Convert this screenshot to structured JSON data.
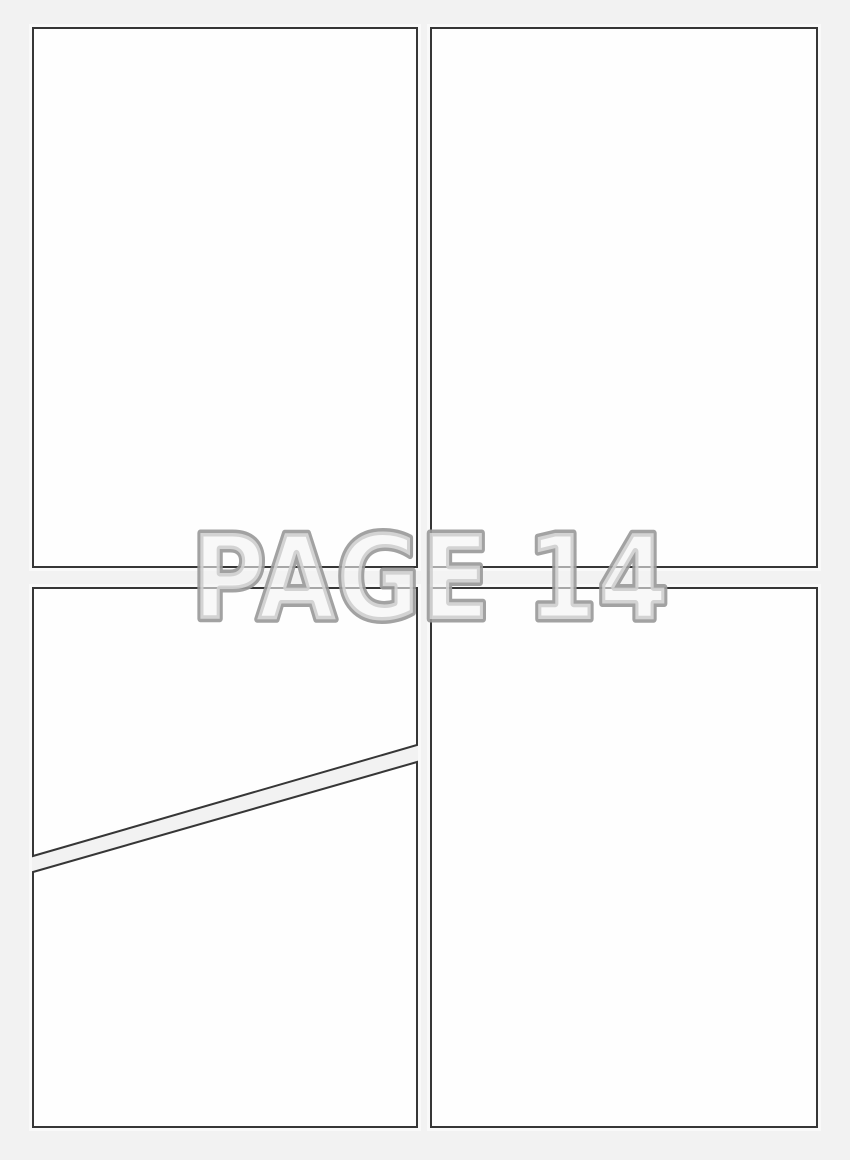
{
  "watermark": {
    "text": "PAGE 14"
  },
  "colors": {
    "page_background": "#f2f2f2",
    "panel_fill": "#fefefe",
    "panel_border": "#363636",
    "watermark_outline": "#9a9a9a",
    "watermark_fill": "#f4f4f4"
  },
  "panels": [
    {
      "name": "panel-top-left",
      "content": ""
    },
    {
      "name": "panel-top-right",
      "content": ""
    },
    {
      "name": "panel-bottom-left-upper",
      "content": ""
    },
    {
      "name": "panel-bottom-left-lower",
      "content": ""
    },
    {
      "name": "panel-bottom-right",
      "content": ""
    }
  ]
}
